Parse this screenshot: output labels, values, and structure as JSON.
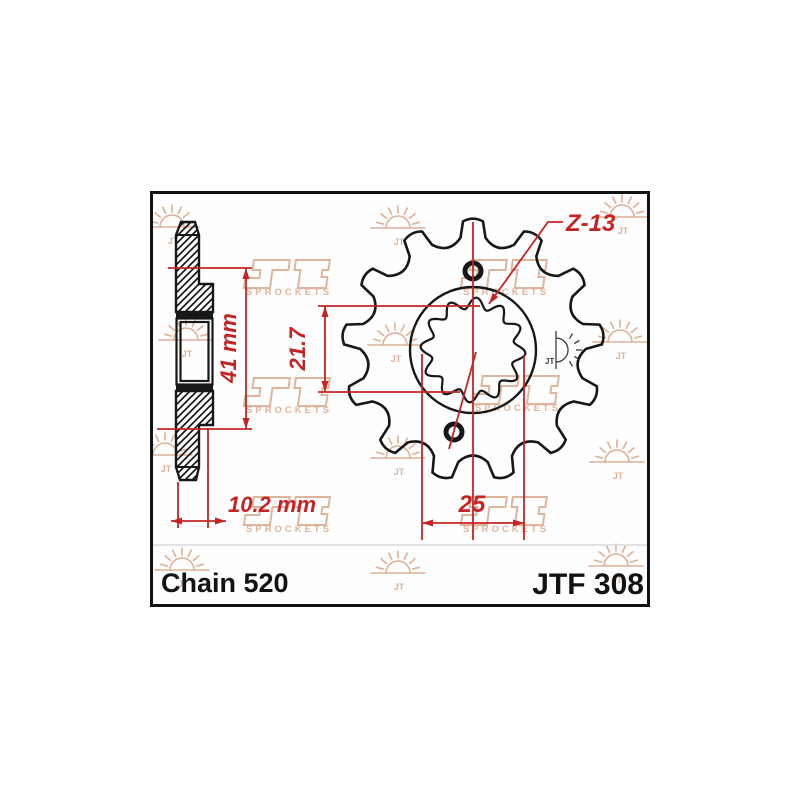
{
  "labels": {
    "chain": "Chain 520",
    "model": "JTF 308"
  },
  "dimensions": {
    "overall_width": "41 mm",
    "hub_thickness": "10.2 mm",
    "spline_flat_height": "21.7",
    "spline_width": "25",
    "teeth": "Z-13"
  },
  "drawing": {
    "colors": {
      "line": "#171717",
      "dimension_red": "#c52424",
      "watermark": "#d9a98c",
      "stamp": "#3c3c3c",
      "separator": "#d8d8d8"
    },
    "sprocket": {
      "cx": 473,
      "cy": 350,
      "teeth": 13,
      "tip_radius": 129,
      "root_radius": 107,
      "bore_radius": 63,
      "spline_mid_radius": 47,
      "spline_amplitude": 5.5,
      "spline_lobes": 12
    },
    "bolt_holes": [
      {
        "cx": 473,
        "cy": 271,
        "r": 8
      },
      {
        "cx": 454,
        "cy": 432,
        "r": 8
      }
    ]
  },
  "watermark": {
    "caption": "SPROCKETS",
    "jt_mark": "JT",
    "suns": [
      [
        172,
        227
      ],
      [
        398,
        228
      ],
      [
        622,
        217
      ],
      [
        186,
        340
      ],
      [
        395,
        345
      ],
      [
        620,
        342
      ],
      [
        165,
        455
      ],
      [
        398,
        458
      ],
      [
        617,
        462
      ],
      [
        182,
        570
      ],
      [
        398,
        573
      ],
      [
        616,
        566
      ]
    ],
    "logos": [
      [
        289,
        274
      ],
      [
        506,
        274
      ],
      [
        289,
        392
      ],
      [
        518,
        390
      ],
      [
        289,
        511
      ],
      [
        506,
        511
      ]
    ]
  }
}
